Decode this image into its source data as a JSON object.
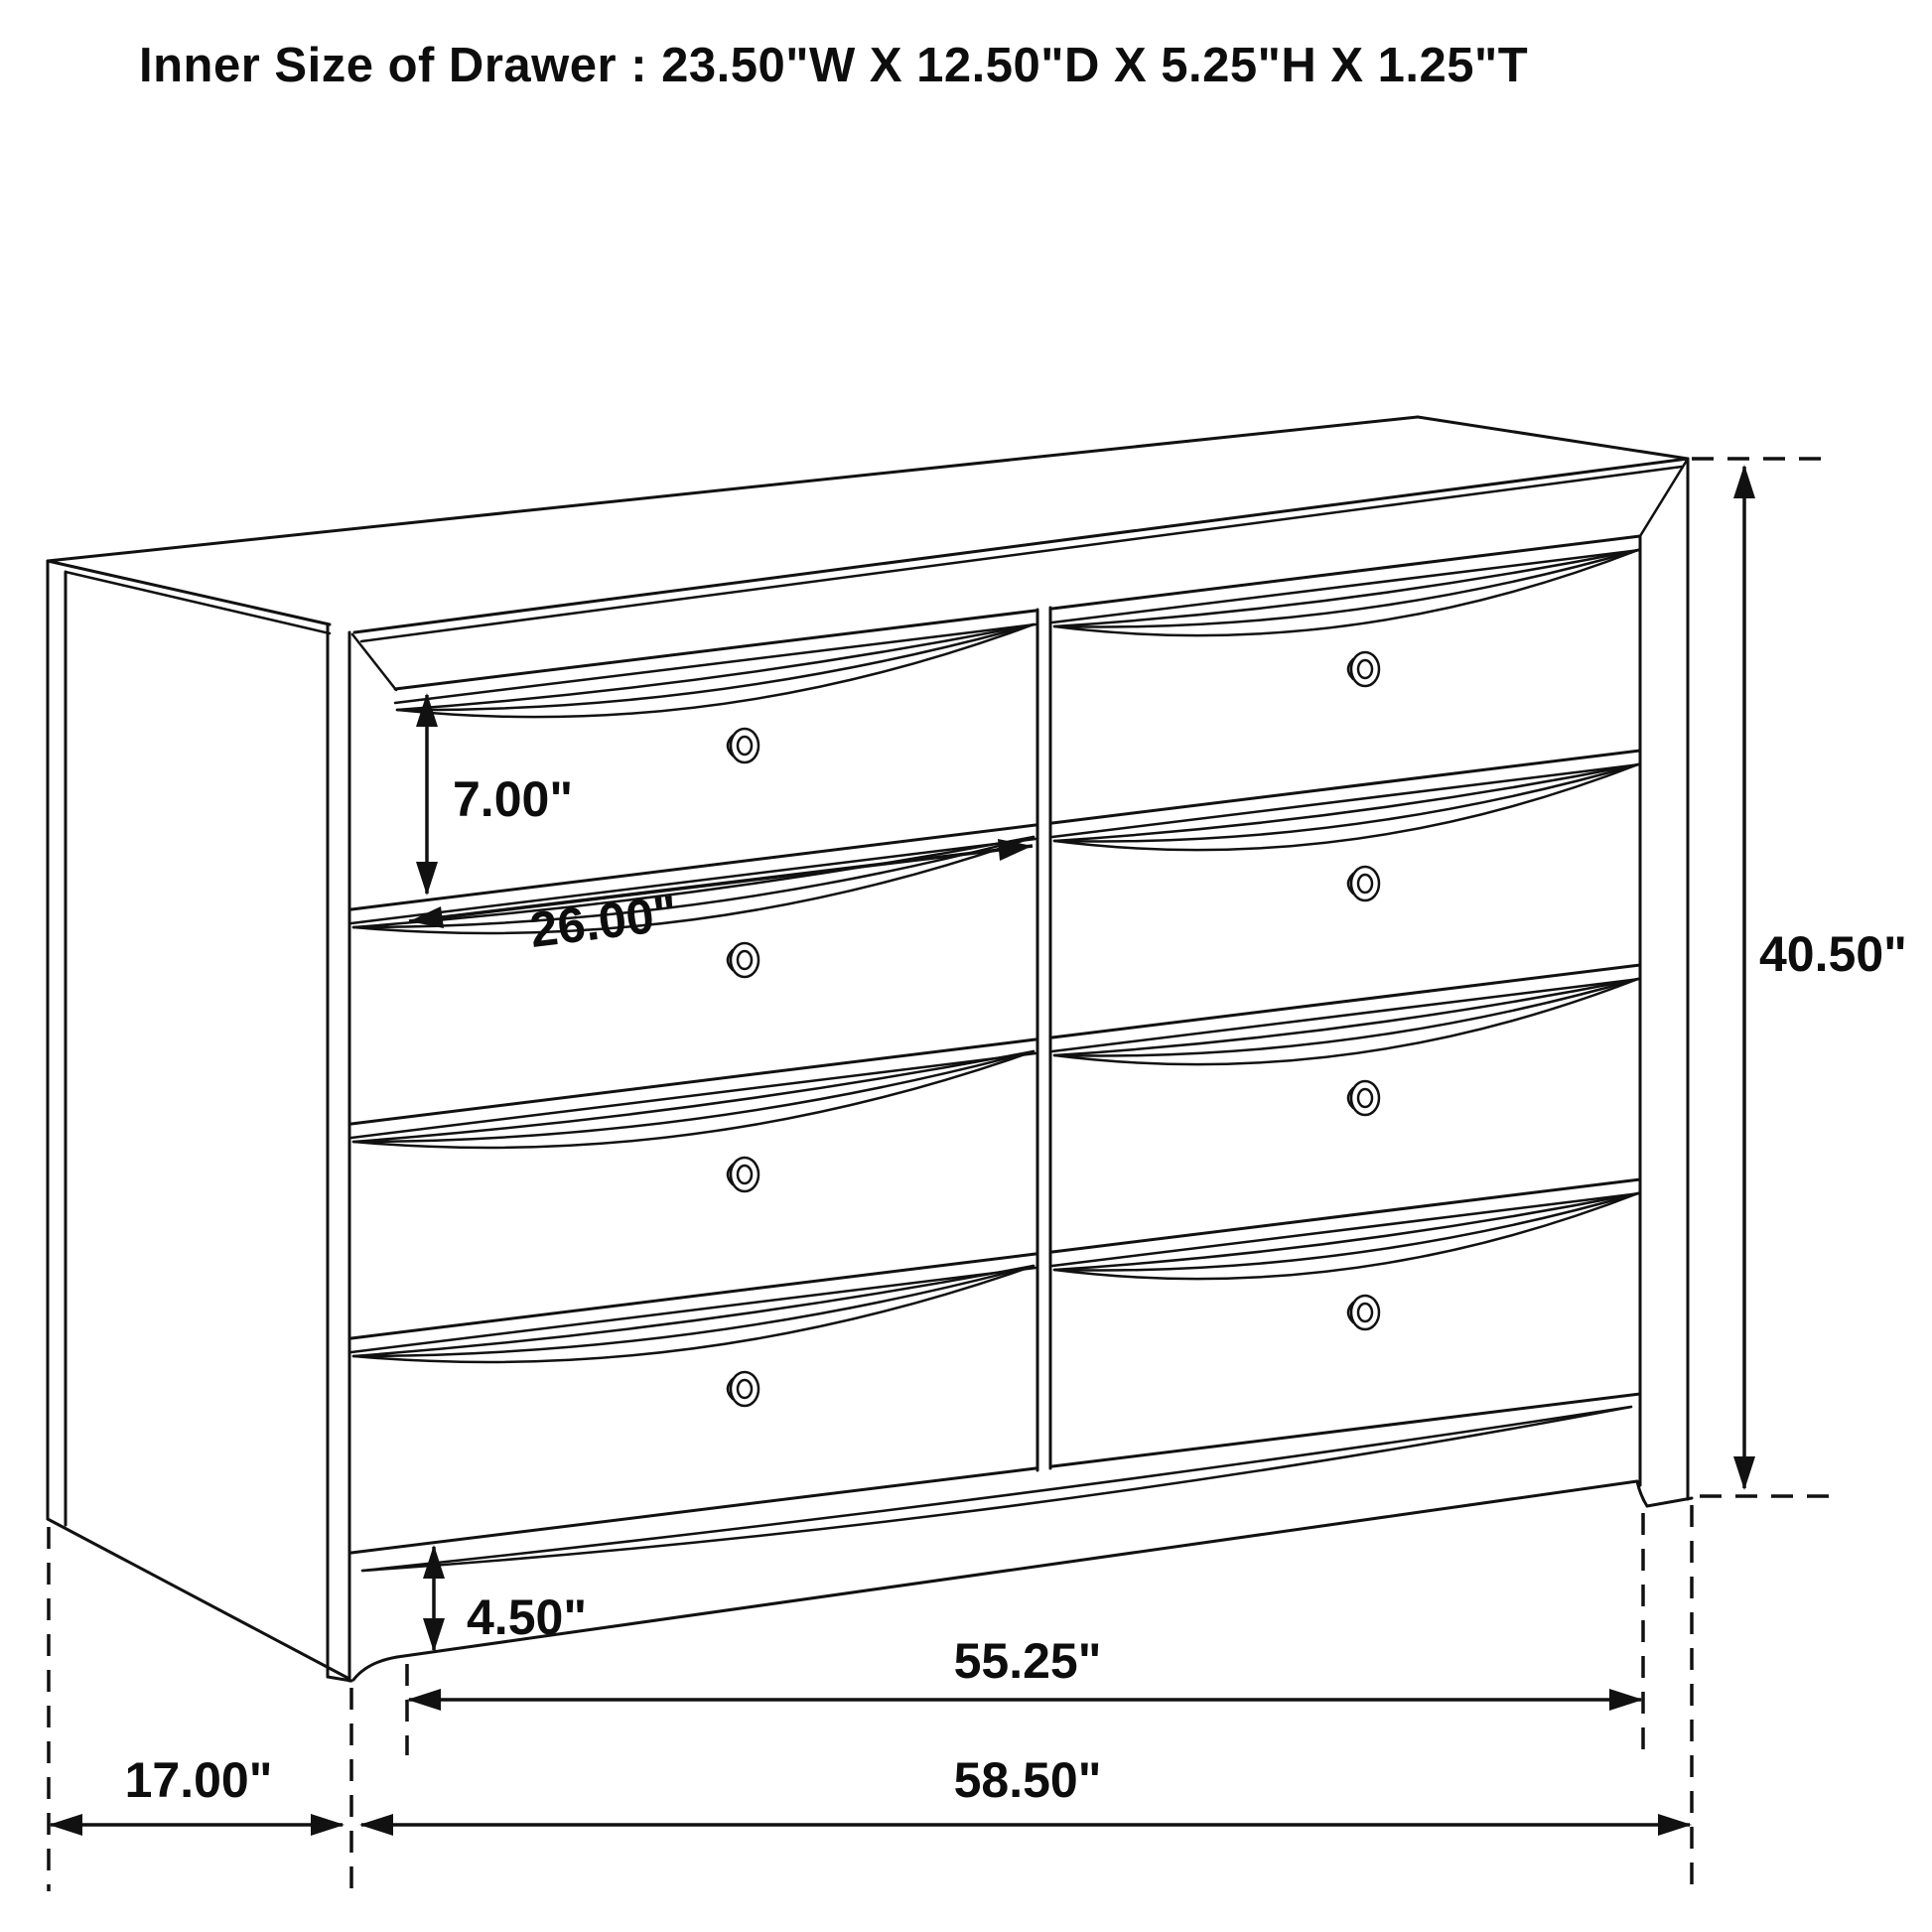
{
  "title": "Inner Size of Drawer : 23.50\"W X 12.50\"D X 5.25\"H X 1.25\"T",
  "diagram": {
    "type": "furniture-dimension-drawing",
    "item": "8-drawer dresser, three-quarter line view",
    "drawer_count": 8,
    "knob_count": 8,
    "line_color": "#111111",
    "background_color": "#ffffff"
  },
  "dimensions": {
    "drawer_face_height": "7.00\"",
    "drawer_width": "26.00\"",
    "overall_height": "40.50\"",
    "leg_height": "4.50\"",
    "width_between_legs": "55.25\"",
    "side_depth": "17.00\"",
    "overall_width": "58.50\""
  }
}
